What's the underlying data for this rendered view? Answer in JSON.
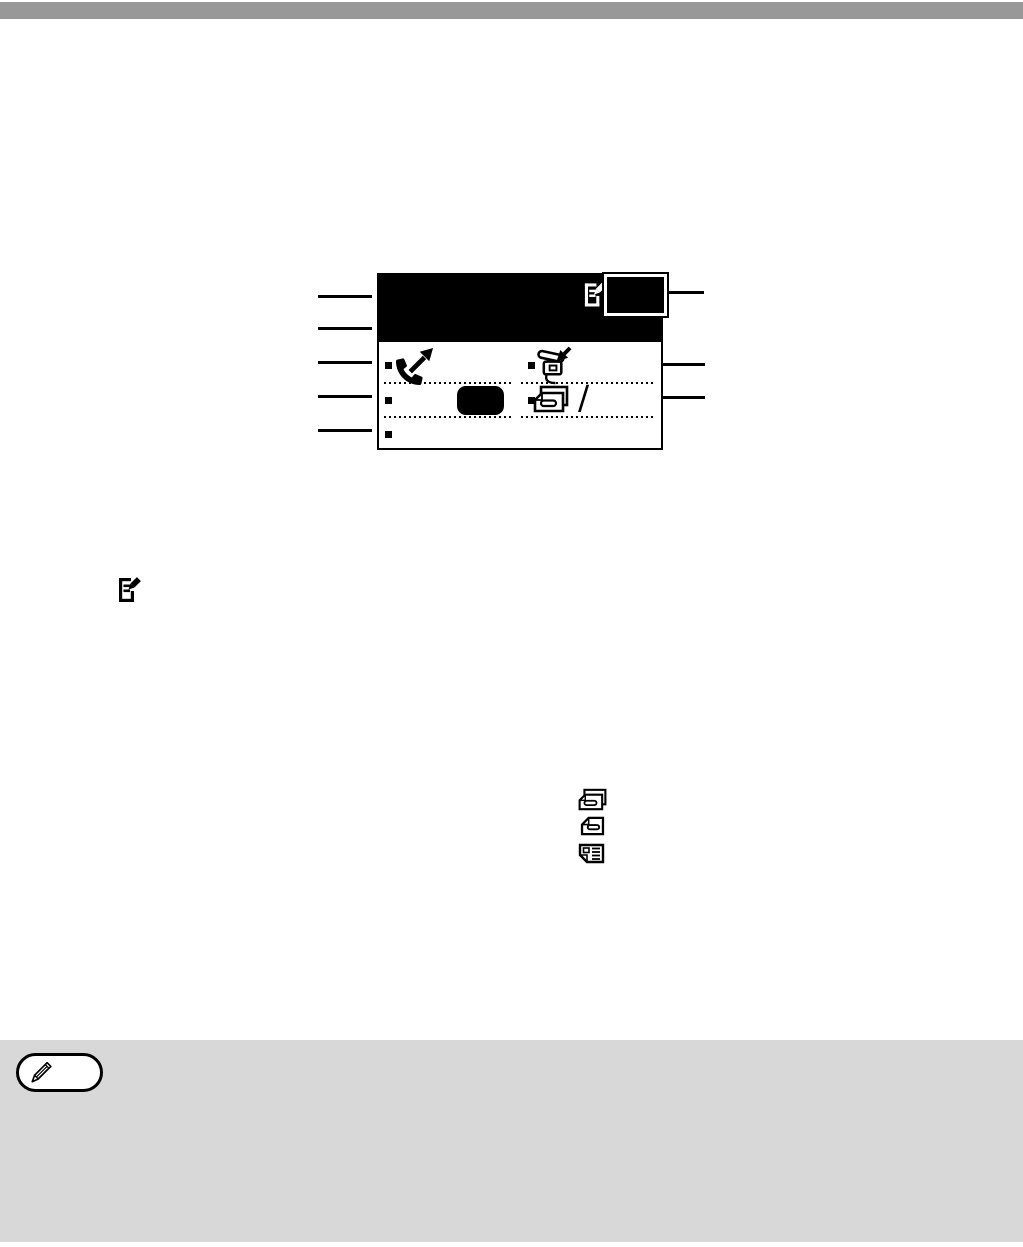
{
  "colors": {
    "top_bar": "#989898",
    "note_box": "#d8d8d8",
    "screen_header": "#000000",
    "highlight_box_border": "#ffffff",
    "ink": "#000000"
  },
  "display_screen_figure": {
    "header": {
      "icon": "document-pen-icon",
      "highlight_box": "highlighted-blank-field"
    },
    "row1": {
      "left_bullet": "small-black-square",
      "left_icon": "phone-line-in-use-icon",
      "right_bullet": "small-black-square",
      "right_icon": "phone-receiving-icon"
    },
    "row2": {
      "left_bullet": "small-black-square",
      "left_shape": "selected-key-highlight",
      "right_bullet": "small-black-square",
      "right_icon": "stacked-documents-icon",
      "slash": "/"
    },
    "row3": {
      "left_bullet": "small-black-square"
    },
    "callout_lines": {
      "left_count": 5,
      "right_count": 3
    }
  },
  "inline_icons": {
    "body_icon": "document-pen-icon",
    "list": [
      "stacked-documents-icon",
      "single-document-icon",
      "dual-page-icon"
    ]
  },
  "note_box": {
    "icon": "pencil-icon"
  }
}
